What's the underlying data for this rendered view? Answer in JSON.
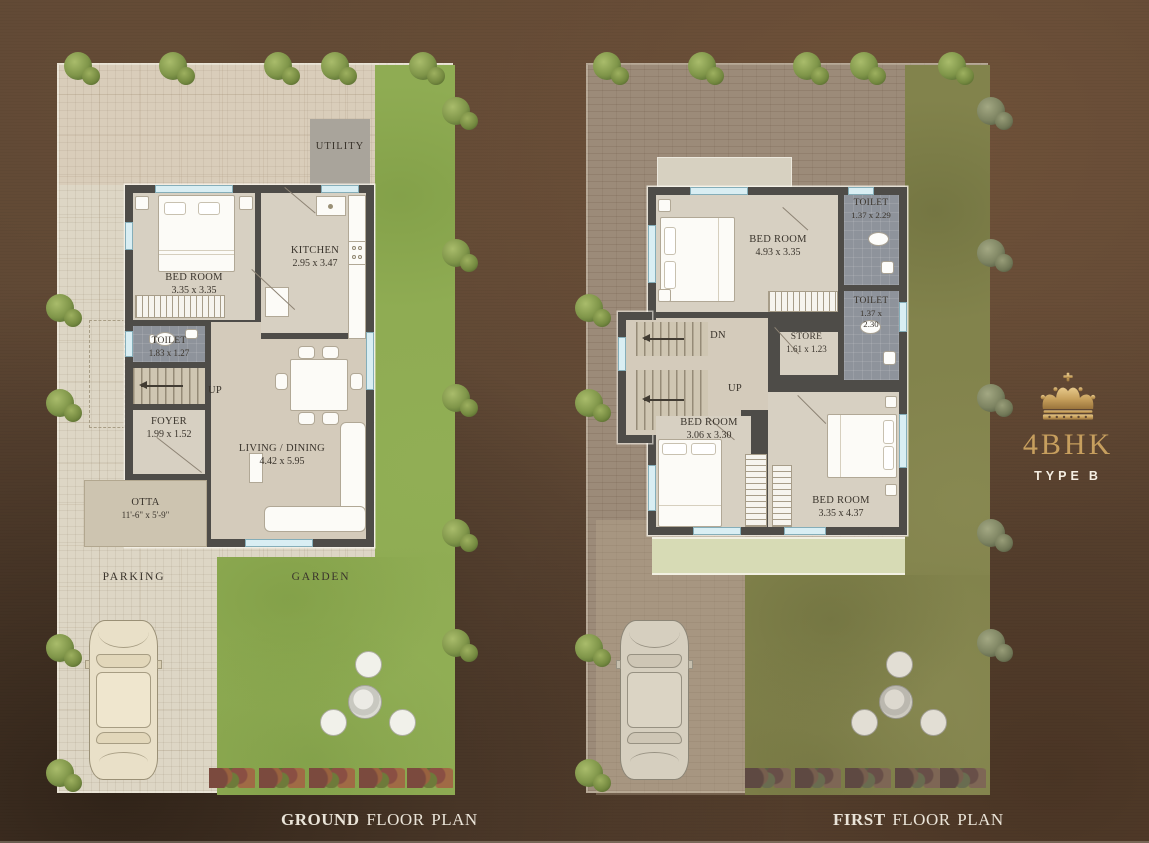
{
  "brand": {
    "crown_icon": "crown",
    "title": "4BHK",
    "type_label": "TYPE",
    "type_value": "B",
    "gold": "#c79f5e"
  },
  "captions": {
    "ground_bold": "GROUND",
    "ground_rest": " FLOOR PLAN",
    "first_bold": "FIRST",
    "first_rest": " FLOOR PLAN"
  },
  "ground_floor": {
    "utility": {
      "name": "UTILITY"
    },
    "bedroom": {
      "name": "BED ROOM",
      "dims": "3.35 x 3.35"
    },
    "kitchen": {
      "name": "KITCHEN",
      "dims": "2.95 x 3.47"
    },
    "toilet": {
      "name": "TOILET",
      "dims": "1.83 x 1.27"
    },
    "stairs": {
      "name": "UP"
    },
    "foyer": {
      "name": "FOYER",
      "dims": "1.99 x 1.52"
    },
    "living": {
      "name": "LIVING / DINING",
      "dims": "4.42 x 5.95"
    },
    "otta": {
      "name": "OTTA",
      "dims": "11'-6\" x 5'-9\""
    },
    "parking": {
      "name": "PARKING"
    },
    "garden": {
      "name": "GARDEN"
    }
  },
  "first_floor": {
    "bedroom1": {
      "name": "BED ROOM",
      "dims": "4.93 x 3.35"
    },
    "toilet1": {
      "name": "TOILET",
      "dims": "1.37 x 2.29"
    },
    "toilet2": {
      "name": "TOILET",
      "dims_l1": "1.37 x",
      "dims_l2": "2.30"
    },
    "store": {
      "name": "STORE",
      "dims": "1.61 x 1.23"
    },
    "stairs_dn": {
      "name": "DN"
    },
    "stairs_up": {
      "name": "UP"
    },
    "bedroom2": {
      "name": "BED ROOM",
      "dims": "3.06 x 3.30"
    },
    "bedroom3": {
      "name": "BED ROOM",
      "dims": "3.35 x 4.37"
    }
  },
  "palette": {
    "background_brown": "#5e4734",
    "paving": "#ddd6c5",
    "garden_green": "#8fac53",
    "first_floor_terrace": "#9c8b79",
    "first_floor_garden": "#82834c",
    "balcony_green": "#d7dbb5",
    "wall": "#4e4c48",
    "toilet_floor": "#8e939b",
    "label_text": "#3a342c"
  }
}
